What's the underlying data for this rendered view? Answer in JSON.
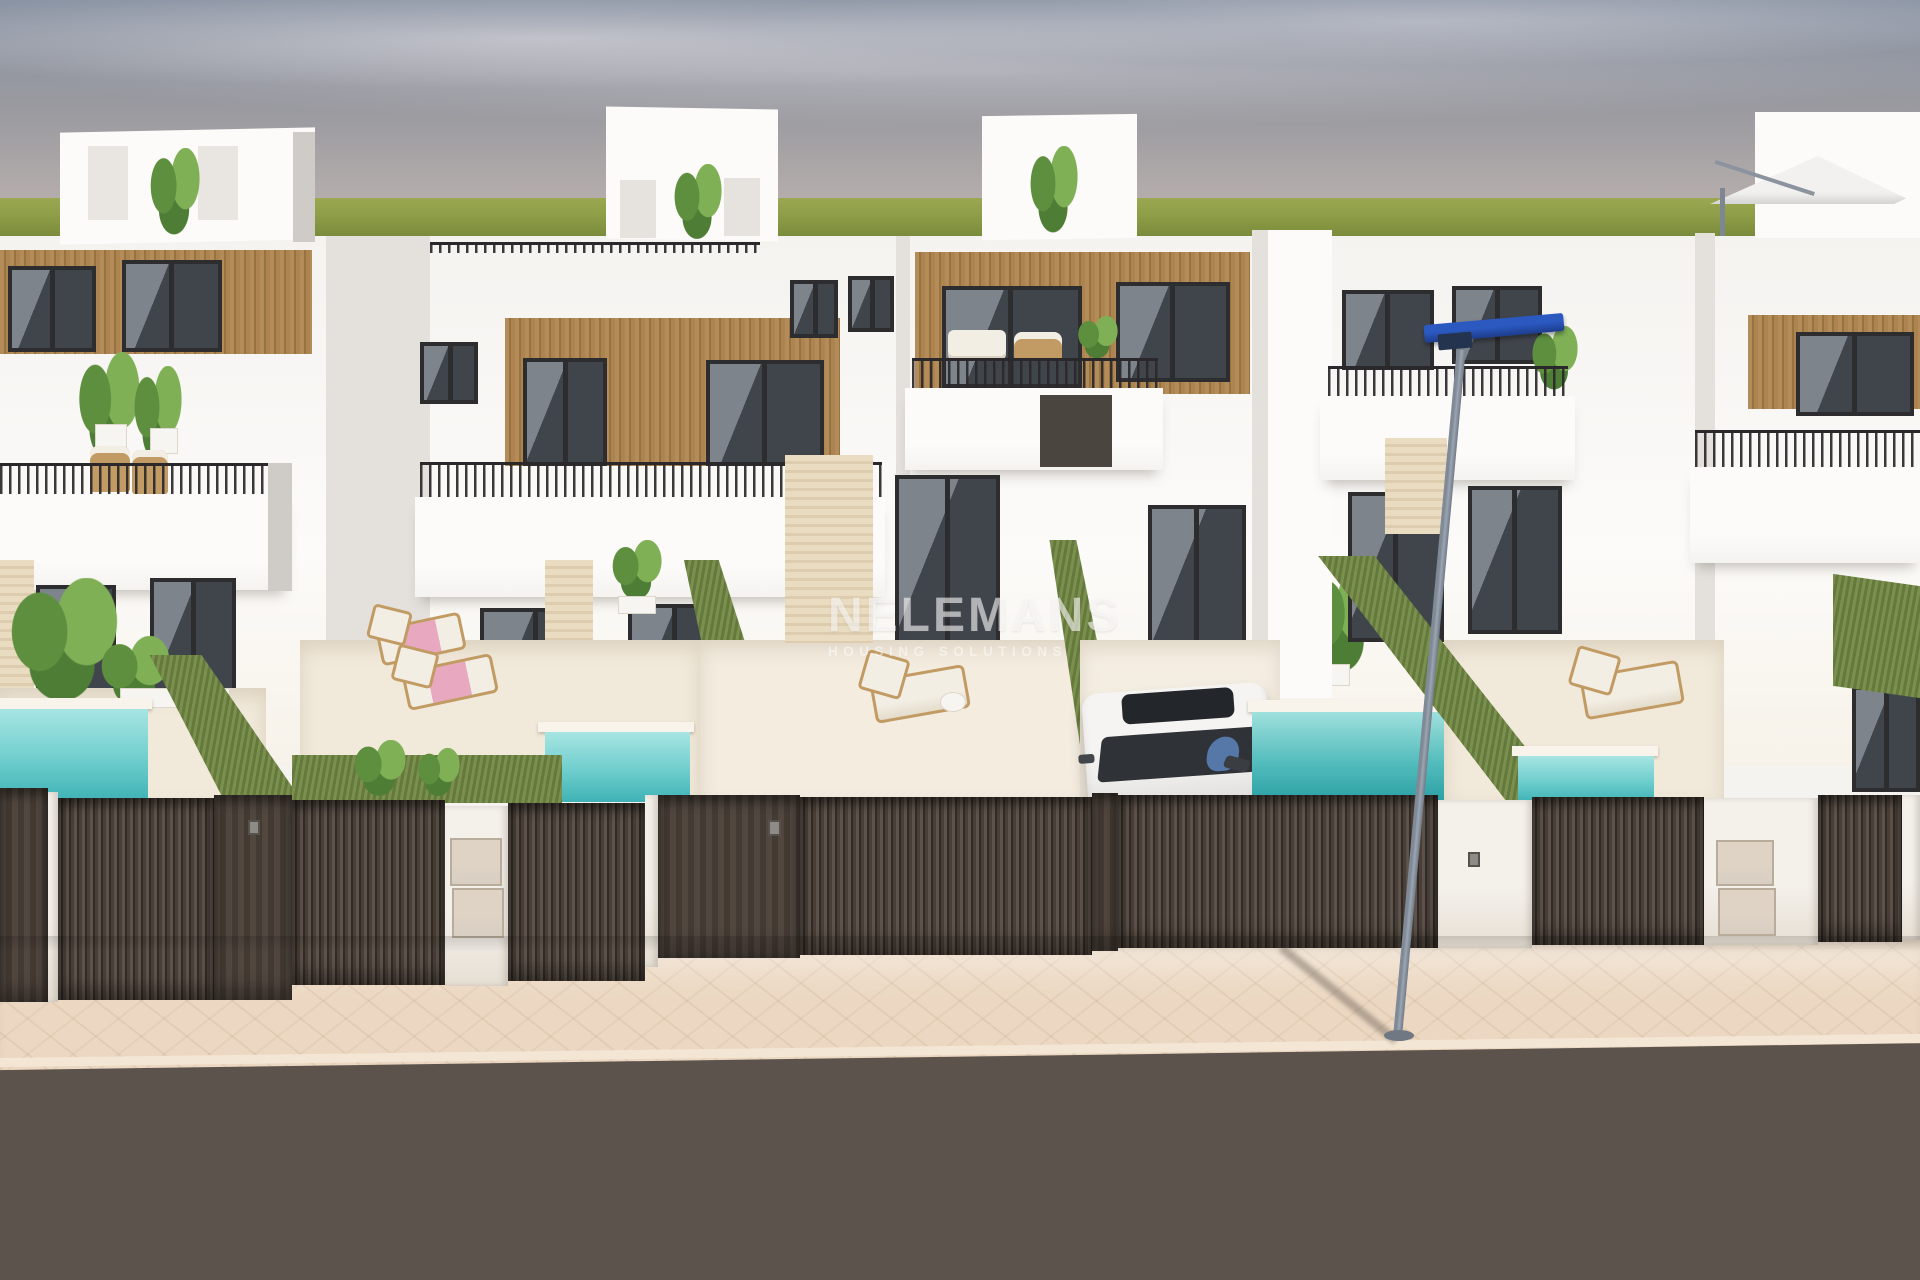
{
  "watermark": {
    "title": "NELEMANS",
    "subtitle": "HOUSING SOLUTIONS"
  },
  "scene": {
    "description": "3D architectural render of a row of modern white two-storey villas with wood-slat accents, rooftop terraces, private plunge pools, dark slatted street fences, a parked white car, a blue street lamp, beige sidewalk and asphalt road",
    "objects": [
      "sky",
      "grass-horizon",
      "white-villas",
      "rooftop-penthouses",
      "roof-parasol",
      "wood-slat-cladding",
      "black-framed-windows",
      "balcony-railings",
      "potted-plants",
      "green-hedges",
      "plunge-pools",
      "sun-loungers",
      "white-car-with-driver",
      "dark-slatted-gates",
      "utility-boxes",
      "access-keypads",
      "street-lamp",
      "paved-sidewalk",
      "asphalt-road",
      "developer-watermark"
    ],
    "counts": {
      "houses": 5,
      "pools": 4,
      "sun_loungers": 4,
      "cars": 1,
      "street_lamps": 1
    }
  },
  "colors": {
    "sky-top": "#8a94a4",
    "sky-mid": "#9a9aa0",
    "sky-low": "#c1b6b0",
    "grass": "#8d9c46",
    "grass-dark": "#75883a",
    "wall": "#f5f3f0",
    "wall-bright": "#fcfbf9",
    "wall-shade": "#e4e1dd",
    "wall-dark": "#cfcbc6",
    "wood": "#b48c5a",
    "wood-dark": "#96733f",
    "frame": "#2d2c2f",
    "glass": "#40454c",
    "glass-light": "#7e848b",
    "hedge": "#7b8f4e",
    "hedge-dark": "#64793c",
    "pool-light": "#a7e5e3",
    "pool-deep": "#3fb2b5",
    "terrace": "#f1e9da",
    "travertine": "#e9dcc0",
    "fence": "#493f38",
    "fence-slat": "#332c26",
    "pier": "#f4f0ea",
    "ubox": "#d8cec2",
    "walk": "#ecd8c2",
    "road": "#5b534c",
    "curb": "#f4e6d4",
    "pole": "#9ba6b2",
    "lamp-blue": "#2b59c0",
    "lamp-navy": "#1d3c8c",
    "car": "#efeeec",
    "windshield": "#2f3338",
    "shirt": "#5678a9",
    "cushion": "#f3eee4",
    "lounger-wood": "#c29b64",
    "pink": "#e7a8c0",
    "plant": "#5d8f3f",
    "plant-light": "#7fb055",
    "watermark": "rgba(255,255,255,0.58)"
  }
}
